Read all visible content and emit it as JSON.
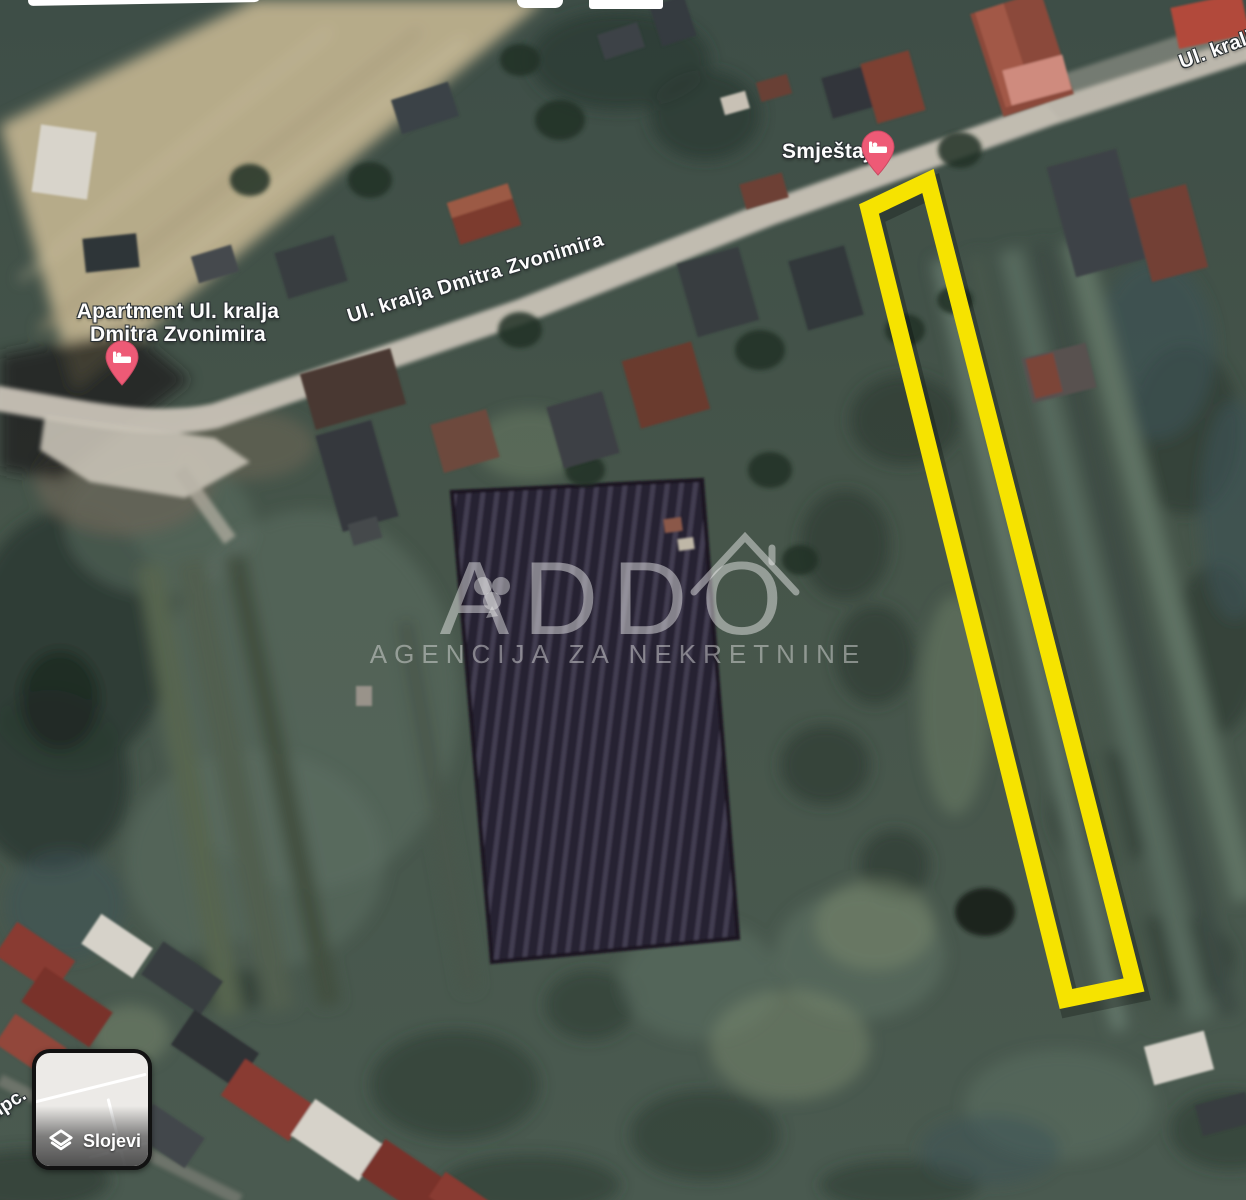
{
  "map_labels": {
    "street_main": "Ul. kralja Dmitra Zvonimira",
    "street_top_right": "Ul. kralj",
    "street_bottom_left_fragment": "upc."
  },
  "pois": {
    "apartment": {
      "line1": "Apartment Ul. kralja",
      "line2": "Dmitra Zvonimira",
      "icon": "lodging-pin-icon"
    },
    "lodging": {
      "label": "Smještaj",
      "icon": "lodging-pin-icon"
    },
    "business": {
      "line1": "LAY OFF JDOO",
      "line2": "ZA PROIZVODNJU I…"
    }
  },
  "parcel_overlay": {
    "color": "#F6E300"
  },
  "watermark": {
    "title": "ADDO",
    "subtitle": "AGENCIJA ZA NEKRETNINE"
  },
  "controls": {
    "layers_button_label": "Slojevi"
  },
  "colors": {
    "pin_fill": "#EE5A76",
    "business_text": "#9FCB97",
    "road": "#C8C2B6"
  }
}
